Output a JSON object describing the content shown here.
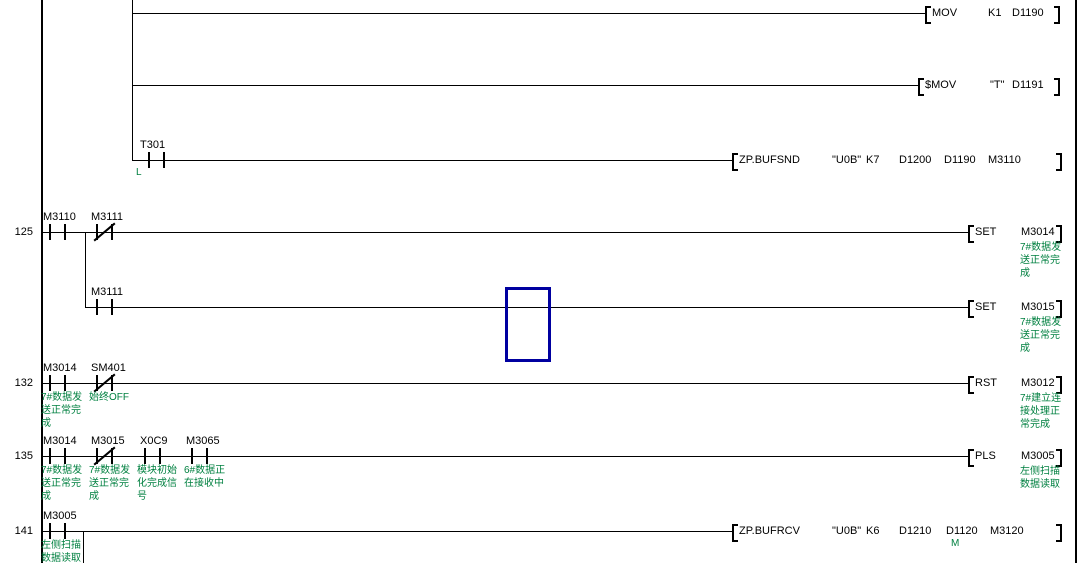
{
  "colors": {
    "annotation_green": "#008040",
    "cursor_blue": "#0000A0",
    "line_black": "#000000",
    "background": "#ffffff"
  },
  "rows": {
    "mov": {
      "op": "MOV",
      "a1": "K1",
      "a2": "D1190"
    },
    "smov": {
      "op": "$MOV",
      "a1": "\"T\"",
      "a2": "D1191"
    },
    "t301": {
      "contact": "T301",
      "marker": "L"
    },
    "bufsnd": {
      "op": "ZP.BUFSND",
      "a1": "\"U0B\"",
      "a2": "K7",
      "a3": "D1200",
      "a4": "D1190",
      "a5": "M3110"
    },
    "r125": {
      "num": "125",
      "c1": "M3110",
      "c2": "M3111",
      "coil_op": "SET",
      "coil_dev": "M3014",
      "coil_ann": "7#数据发送正常完成"
    },
    "r125b": {
      "c1": "M3111",
      "coil_op": "SET",
      "coil_dev": "M3015",
      "coil_ann": "7#数据发送正常完成"
    },
    "r132": {
      "num": "132",
      "c1": "M3014",
      "c1_ann": "7#数据发送正常完成",
      "c2": "SM401",
      "c2_ann": "始终OFF",
      "coil_op": "RST",
      "coil_dev": "M3012",
      "coil_ann": "7#建立连接处理正常完成"
    },
    "r135": {
      "num": "135",
      "c1": "M3014",
      "c1_ann": "7#数据发送正常完成",
      "c2": "M3015",
      "c2_ann": "7#数据发送正常完成",
      "c3": "X0C9",
      "c3_ann": "模块初始化完成信号",
      "c4": "M3065",
      "c4_ann": "6#数据正在接收中",
      "coil_op": "PLS",
      "coil_dev": "M3005",
      "coil_ann": "左侧扫描数据读取"
    },
    "r141": {
      "num": "141",
      "c1": "M3005",
      "c1_ann": "左侧扫描数据读取",
      "op": "ZP.BUFRCV",
      "a1": "\"U0B\"",
      "a2": "K6",
      "a3": "D1210",
      "a4": "D1120",
      "a4_marker": "M",
      "a5": "M3120"
    }
  }
}
